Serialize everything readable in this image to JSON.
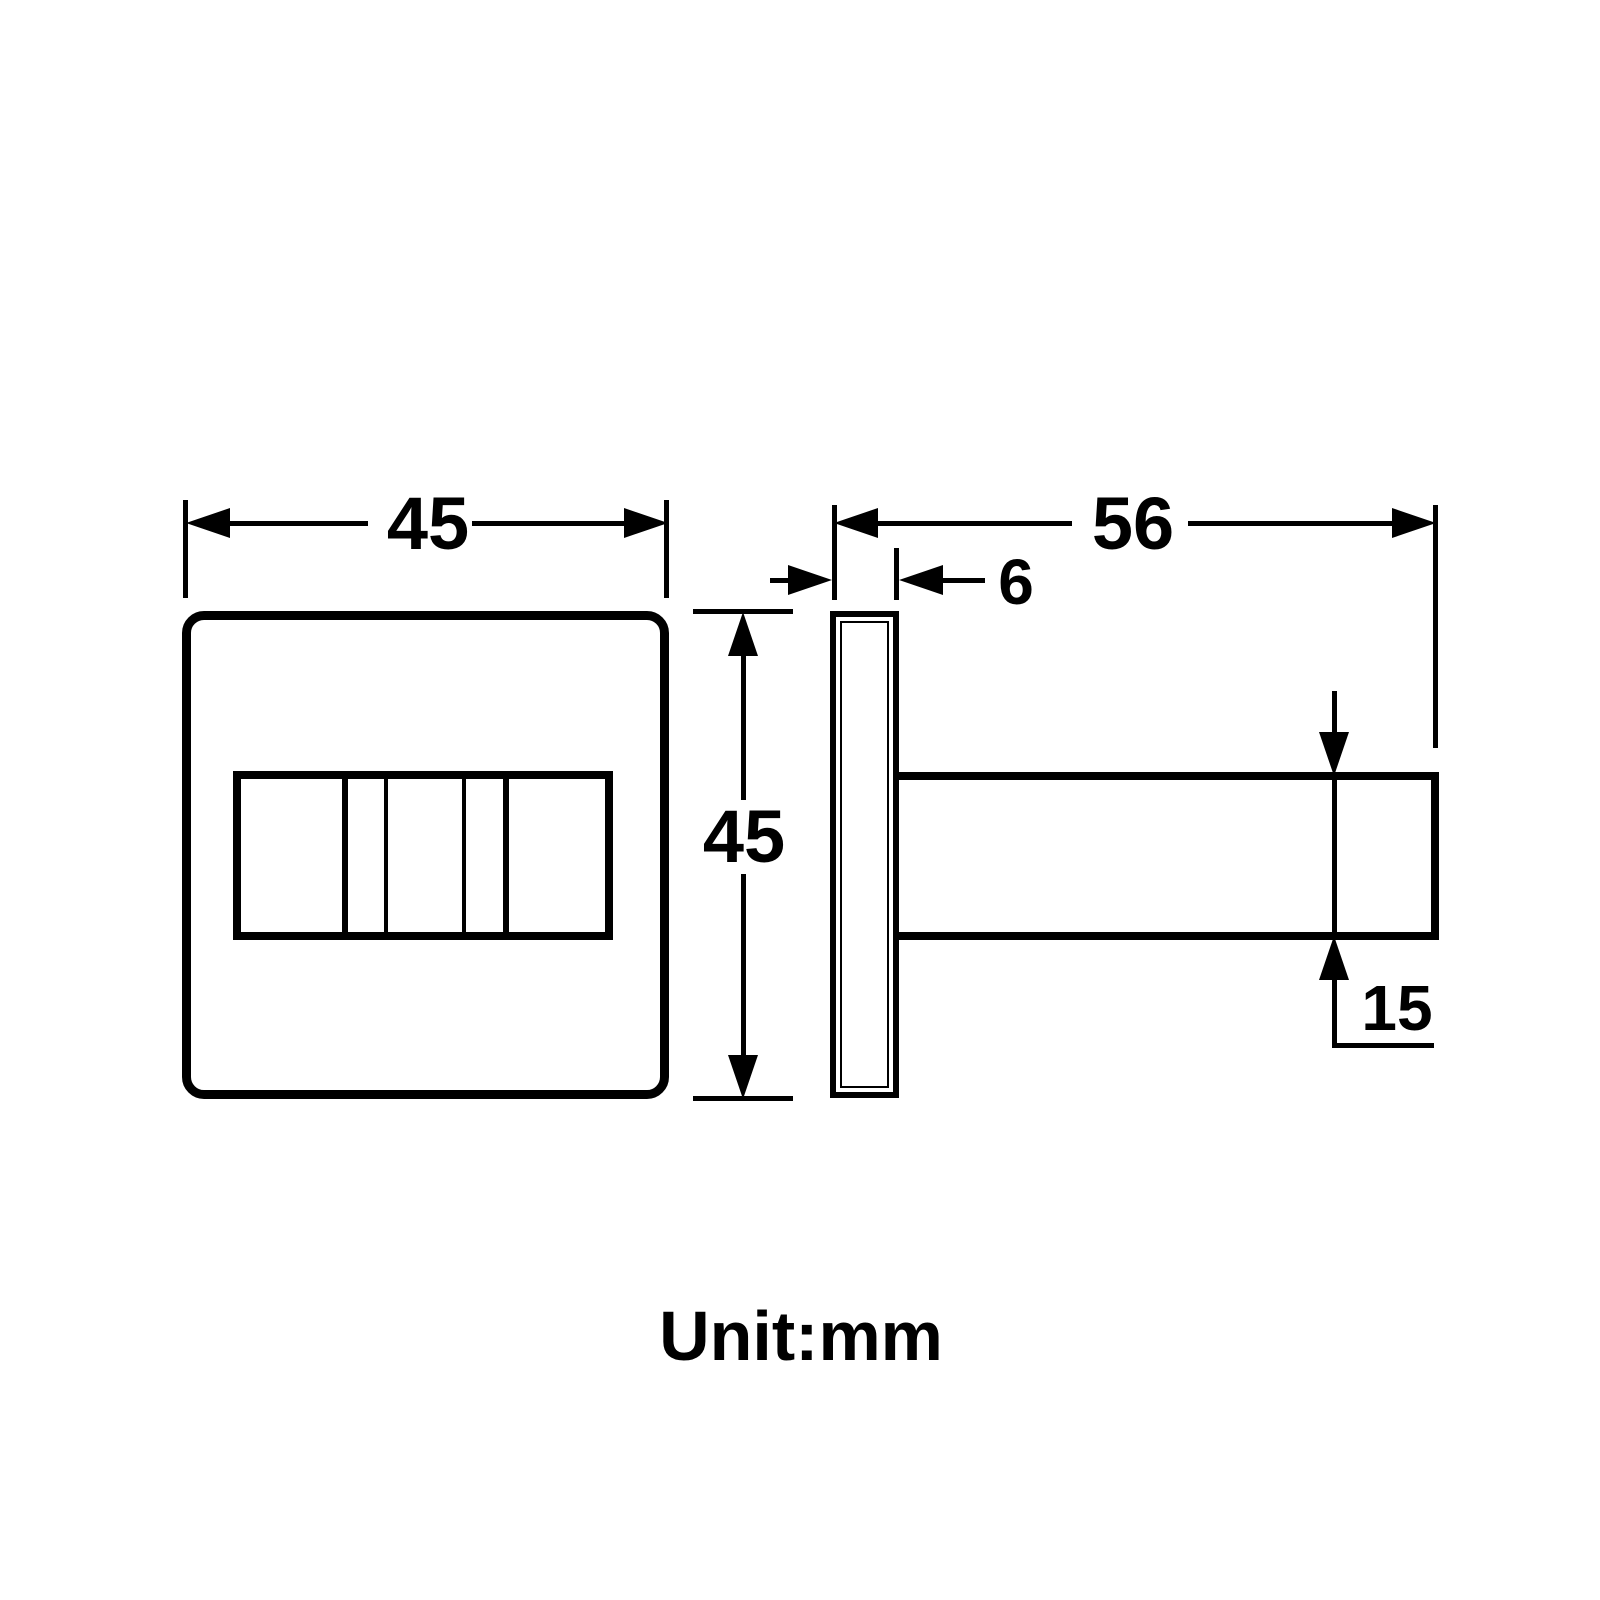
{
  "drawing": {
    "unit_label": "Unit:mm",
    "dimensions": {
      "front_width": "45",
      "front_height": "45",
      "side_length": "56",
      "plate_thickness": "6",
      "arm_height": "15"
    },
    "colors": {
      "line": "#000000",
      "background": "#ffffff"
    }
  }
}
